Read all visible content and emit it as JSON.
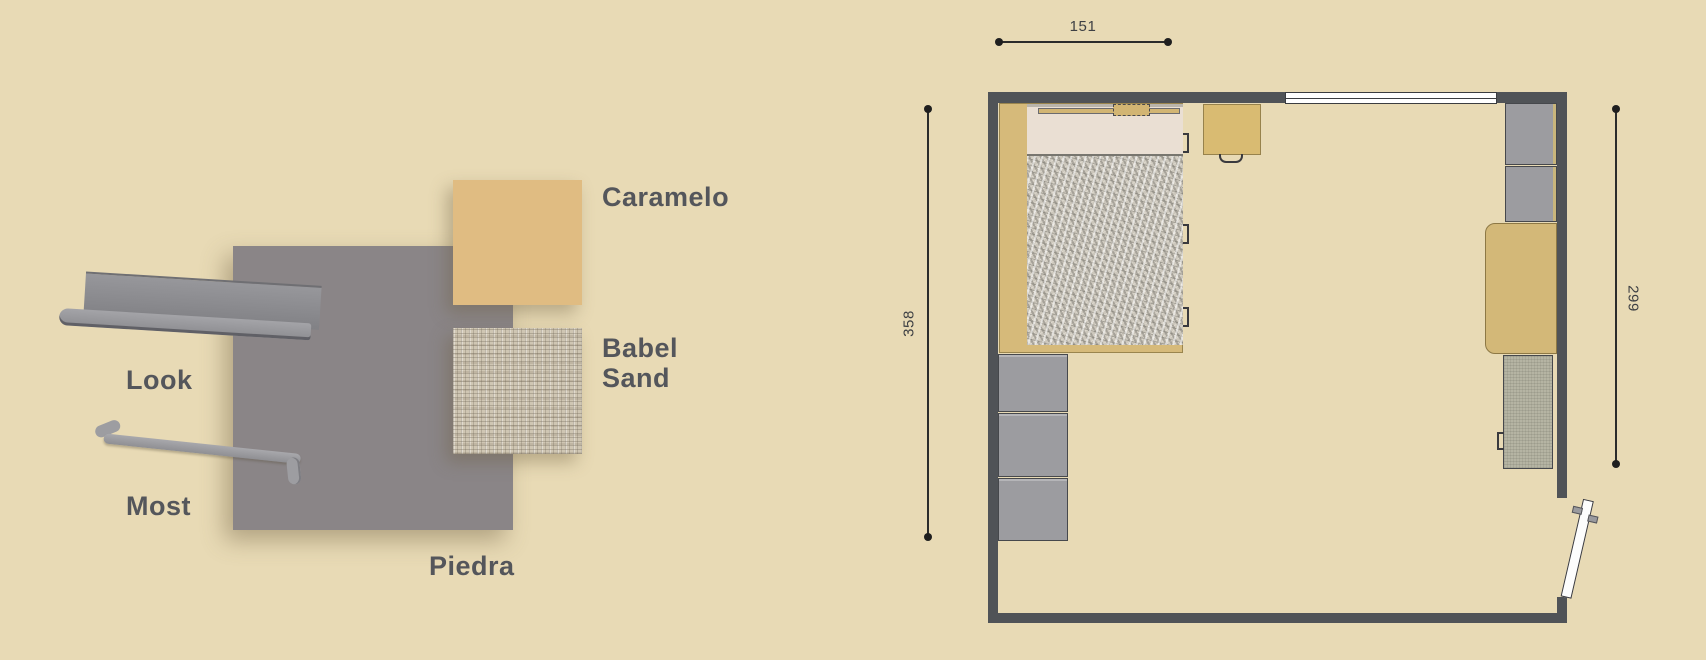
{
  "background": "#e8dab5",
  "moodboard": {
    "look": {
      "label": "Look"
    },
    "most": {
      "label": "Most"
    },
    "piedra": {
      "label": "Piedra",
      "color": "#8a8587"
    },
    "caramelo": {
      "label": "Caramelo",
      "color": "#e0bc82"
    },
    "babel_sand": {
      "label_line1": "Babel",
      "label_line2": "Sand"
    }
  },
  "floorplan": {
    "dim_top": "151",
    "dim_left": "358",
    "dim_right": "299",
    "wall_color": "#505357"
  }
}
